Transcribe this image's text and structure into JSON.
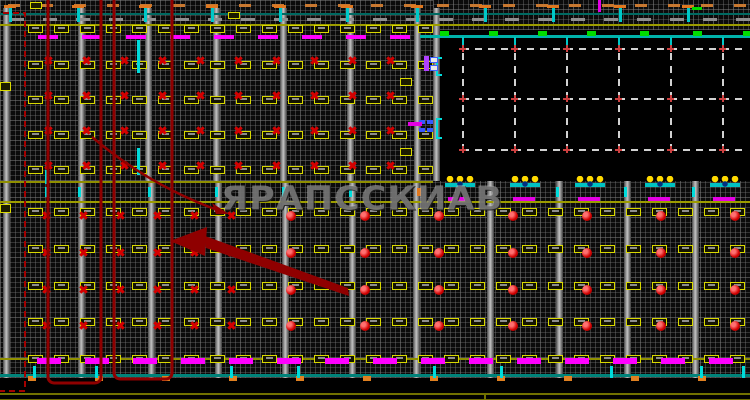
{
  "watermark": {
    "text": "ЯРАПССКИАВ"
  },
  "drawing": {
    "grid_regions": [
      [
        0,
        0,
        433,
        181
      ],
      [
        433,
        0,
        317,
        30
      ],
      [
        0,
        181,
        750,
        197
      ]
    ],
    "columns_top": {
      "xs": [
        3,
        78,
        145,
        213,
        280,
        347,
        414,
        433
      ],
      "y": 8,
      "h": 173
    },
    "columns_bottom": {
      "xs": [
        3,
        78,
        148,
        215,
        282,
        349,
        413,
        487,
        556,
        624,
        692
      ],
      "y": 181,
      "h": 197
    },
    "hlines": [
      [
        0,
        13,
        750,
        2,
        "#006a62"
      ],
      [
        0,
        24,
        750,
        2,
        "#9c9c00"
      ],
      [
        420,
        35,
        330,
        3,
        "#00b2aa"
      ],
      [
        0,
        181,
        433,
        2,
        "#8f8f00"
      ],
      [
        0,
        201,
        750,
        2,
        "#9c9c00"
      ],
      [
        0,
        358,
        750,
        2,
        "#8f8f00"
      ],
      [
        0,
        374,
        750,
        3,
        "#00837a"
      ],
      [
        0,
        393,
        750,
        2,
        "#717100"
      ],
      [
        0,
        399,
        750,
        2,
        "#6a6a00"
      ],
      [
        484,
        393,
        2,
        8,
        "#717100",
        "v"
      ]
    ],
    "dash_rows": [
      {
        "y": 4,
        "start": 8,
        "pitch": 33,
        "w": 12,
        "h": 3,
        "x1": 750,
        "color": "#c87830"
      },
      {
        "y": 18,
        "start": 10,
        "pitch": 33,
        "w": 14,
        "h": 3,
        "x1": 750,
        "color": "#8f8f8f"
      }
    ],
    "t_marks": {
      "xs": [
        10,
        78,
        145,
        212,
        280,
        347,
        417,
        485,
        553,
        620,
        688
      ],
      "bar_y": 5,
      "stem_y": 8
    },
    "tag_rows_top": {
      "ys": [
        25,
        61,
        96,
        131,
        166
      ],
      "start": 28,
      "pitch": 26,
      "x1": 425
    },
    "tag_rows_bottom": {
      "ys": [
        208,
        245,
        282,
        318,
        355
      ],
      "start": 28,
      "pitch": 26,
      "x1": 745
    },
    "cross_rows_top": {
      "ys": [
        56,
        91,
        126,
        161
      ],
      "start": 44,
      "pitch": 38,
      "x1": 420
    },
    "cross_rows_bottom": {
      "ys": [
        211,
        248,
        285,
        321
      ],
      "start": 42,
      "pitch": 37,
      "x1": 258
    },
    "dot_rows": {
      "ys": [
        211,
        248,
        285,
        321
      ],
      "start": 286,
      "pitch": 74,
      "x1": 745
    },
    "magenta_row_top": {
      "y": 35,
      "start": 38,
      "pitch": 44,
      "w": 20,
      "h": 4,
      "x1": 425
    },
    "magenta_row_bottom": {
      "y": 358,
      "start": 37,
      "pitch": 48,
      "w": 24,
      "h": 6,
      "x1": 740
    },
    "mid_magenta": {
      "y": 197,
      "w": 22,
      "h": 4,
      "xs": [
        448,
        513,
        578,
        648,
        713
      ]
    },
    "crowns": {
      "y": 176,
      "xs": [
        445,
        510,
        575,
        645,
        710
      ]
    },
    "mid_cyan_ticks": {
      "y": 187,
      "h": 10,
      "xs": [
        45,
        78,
        148,
        215,
        282,
        349,
        556,
        624,
        692
      ]
    },
    "mid_orange_tick": [
      417,
      188,
      4,
      8
    ],
    "black_area": {
      "stems": {
        "xs": [
          462,
          514,
          566,
          618,
          670,
          722
        ],
        "y": 37,
        "h": 11
      },
      "greens": {
        "xs": [
          440,
          489,
          538,
          587,
          640,
          693,
          743
        ],
        "y": 31
      },
      "dash_h": {
        "ys": [
          48,
          98,
          149
        ],
        "x": 462,
        "w": 286
      },
      "dash_v": {
        "xs": [
          462,
          514,
          566,
          618,
          670,
          722
        ],
        "y": 48,
        "h": 103
      }
    },
    "cyan_vticks": [
      [
        137,
        40,
        3,
        33
      ],
      [
        137,
        148,
        3,
        27
      ],
      [
        45,
        170,
        3,
        14
      ]
    ],
    "cyan_brackets": [
      [
        436,
        57,
        6,
        19
      ],
      [
        436,
        118,
        6,
        21
      ]
    ],
    "clusters": {
      "purple_bar": [
        424,
        56,
        5,
        15
      ],
      "white_boxes": [
        [
          430,
          57,
          8,
          6
        ],
        [
          430,
          65,
          8,
          6
        ]
      ],
      "blue_dashes": [
        [
          419,
          120,
          6,
          4
        ],
        [
          427,
          120,
          6,
          4
        ],
        [
          419,
          128,
          6,
          4
        ],
        [
          427,
          128,
          6,
          4
        ]
      ],
      "magenta_mid": [
        [
          408,
          122,
          14,
          4
        ]
      ]
    },
    "yellow_boxes": [
      [
        0,
        82,
        11,
        9
      ],
      [
        0,
        204,
        11,
        9
      ],
      [
        30,
        2,
        12,
        7
      ],
      [
        228,
        12,
        12,
        7
      ],
      [
        400,
        78,
        12,
        8
      ],
      [
        400,
        148,
        12,
        8
      ]
    ],
    "bottom_band": {
      "orange": {
        "start": 28,
        "pitch": 67,
        "y": 376,
        "w": 8,
        "h": 5
      },
      "cyan": {
        "xs": [
          33,
          95,
          230,
          297,
          433,
          500,
          610,
          700,
          742
        ],
        "y": 366,
        "h": 12
      }
    },
    "top_right_extras": {
      "magenta_v": [
        598,
        0,
        3,
        12
      ],
      "green_dash": [
        692,
        7,
        10,
        3
      ]
    }
  }
}
